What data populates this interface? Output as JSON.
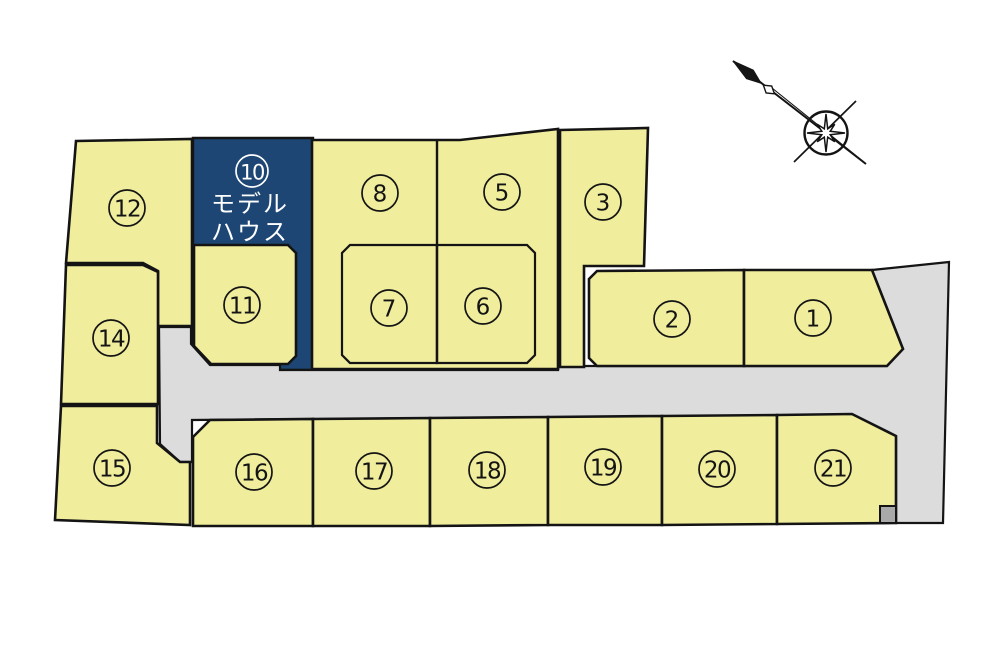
{
  "map": {
    "compass_icon": "compass-rose",
    "colors": {
      "lot_fill": "#f0ed9d",
      "road_fill": "#dcdcdc",
      "outline": "#141414",
      "model_house_fill": "#1d4674",
      "model_house_text": "#ffffff",
      "corner_marker_fill": "#a9a9a9"
    },
    "model_house": {
      "lot_number": "10",
      "label_lines": [
        "モデル",
        "ハウス"
      ]
    },
    "lots": [
      {
        "number": "12"
      },
      {
        "number": "10",
        "type": "model_house"
      },
      {
        "number": "8"
      },
      {
        "number": "5"
      },
      {
        "number": "3"
      },
      {
        "number": "14"
      },
      {
        "number": "11"
      },
      {
        "number": "7"
      },
      {
        "number": "6"
      },
      {
        "number": "2"
      },
      {
        "number": "1"
      },
      {
        "number": "15"
      },
      {
        "number": "16"
      },
      {
        "number": "17"
      },
      {
        "number": "18"
      },
      {
        "number": "19"
      },
      {
        "number": "20"
      },
      {
        "number": "21"
      }
    ]
  }
}
